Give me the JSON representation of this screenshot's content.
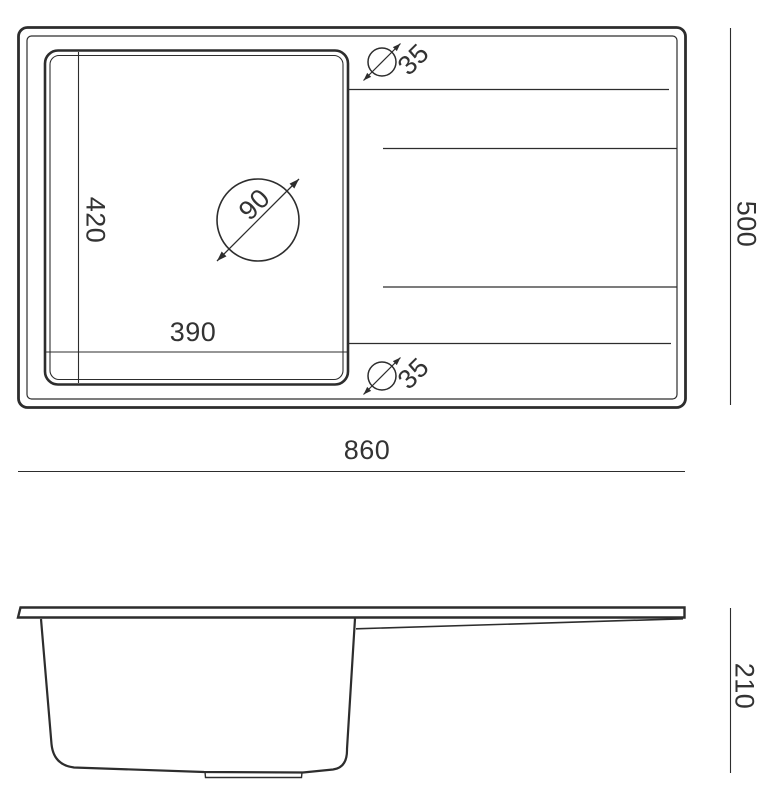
{
  "drawing": {
    "title": "Kitchen sink dimensional drawing",
    "top_view": {
      "bowl_inner_width_mm": "390",
      "bowl_inner_depth_mm": "420",
      "drain_hole_diameter_mm": "90",
      "tap_hole_top_diameter_mm": "35",
      "tap_hole_bottom_diameter_mm": "35",
      "overall_length_mm": "860",
      "overall_width_mm": "500"
    },
    "side_view": {
      "overall_height_mm": "210"
    },
    "colors": {
      "line": "#2d2d2d",
      "text": "#333333",
      "background": "#ffffff"
    }
  }
}
